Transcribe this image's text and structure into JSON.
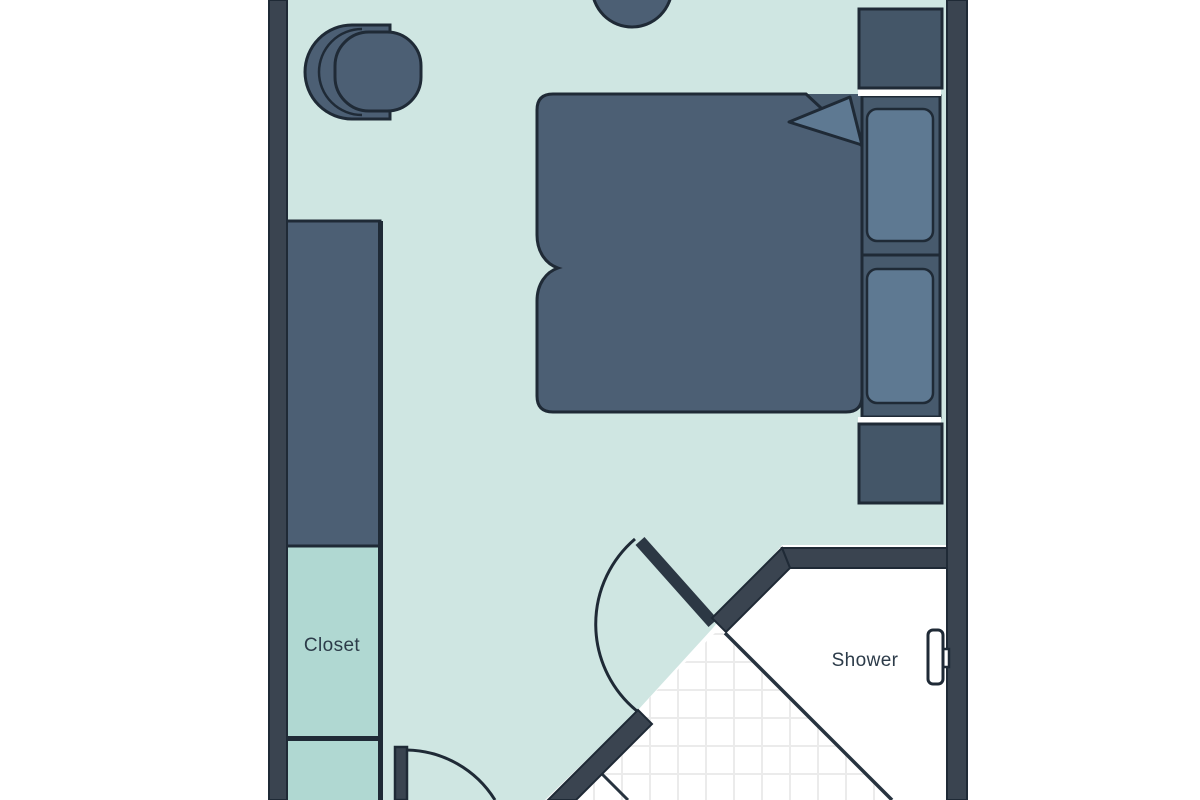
{
  "floorplan": {
    "title": "Hotel room floor plan",
    "labels": {
      "closet": "Closet",
      "shower": "Shower"
    },
    "colors": {
      "background": "#ffffff",
      "wall": "#3a4450",
      "outline": "#1f2a36",
      "floor": "#cfe6e2",
      "closet_floor": "#b0d8d2",
      "bathroom_floor": "#ffffff",
      "tile_line": "#ebebeb",
      "furniture": "#4c5f74",
      "furniture_light": "#5e7992",
      "bed_base": "#475a6d",
      "nightstand": "#445668",
      "fixture_fill": "#ffffff",
      "label_text": "#2c3b49"
    },
    "items": [
      {
        "name": "armchair"
      },
      {
        "name": "round-side-table"
      },
      {
        "name": "wardrobe"
      },
      {
        "name": "closet"
      },
      {
        "name": "double-bed"
      },
      {
        "name": "pillow"
      },
      {
        "name": "pillow"
      },
      {
        "name": "nightstand"
      },
      {
        "name": "nightstand"
      },
      {
        "name": "entry-door"
      },
      {
        "name": "bathroom-door"
      },
      {
        "name": "shower"
      },
      {
        "name": "shower-fixture"
      }
    ]
  }
}
